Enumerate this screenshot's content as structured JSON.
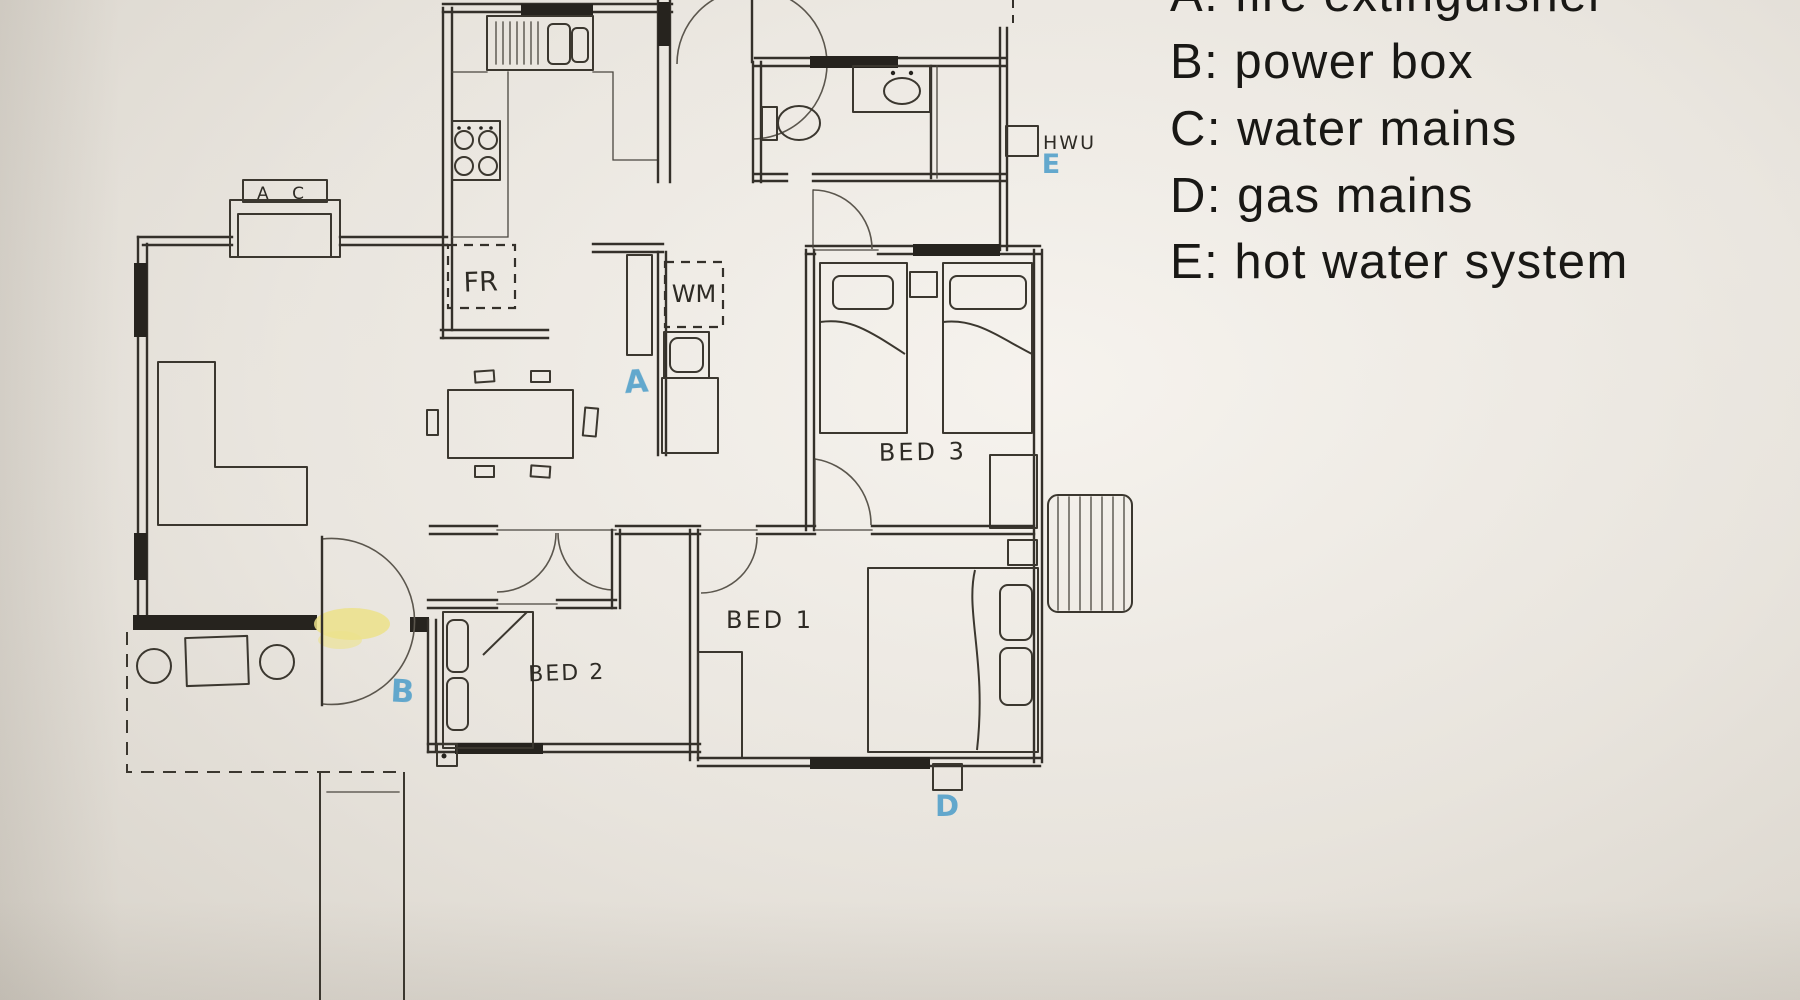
{
  "legend": {
    "items": [
      {
        "key": "A",
        "text": "A: fire extinguisher"
      },
      {
        "key": "B",
        "text": "B: power box"
      },
      {
        "key": "C",
        "text": "C: water mains"
      },
      {
        "key": "D",
        "text": "D: gas mains"
      },
      {
        "key": "E",
        "text": "E: hot water system"
      }
    ]
  },
  "plan": {
    "rooms": [
      {
        "id": "bed1",
        "label": "BED 1"
      },
      {
        "id": "bed2",
        "label": "BED 2"
      },
      {
        "id": "bed3",
        "label": "BED 3"
      }
    ],
    "labels": {
      "fridge": "FR",
      "washing_machine": "WM",
      "air_conditioner": "A C",
      "hot_water_unit": "HWU"
    },
    "markers": [
      {
        "key": "A",
        "meaning": "fire extinguisher"
      },
      {
        "key": "B",
        "meaning": "power box"
      },
      {
        "key": "D",
        "meaning": "gas mains"
      },
      {
        "key": "E",
        "meaning": "hot water system"
      }
    ],
    "colors": {
      "marker_blue": "#4f9fca",
      "highlight_yellow": "#ece28a",
      "ink": "#2f2c27",
      "paper": "#e9e5df"
    }
  }
}
